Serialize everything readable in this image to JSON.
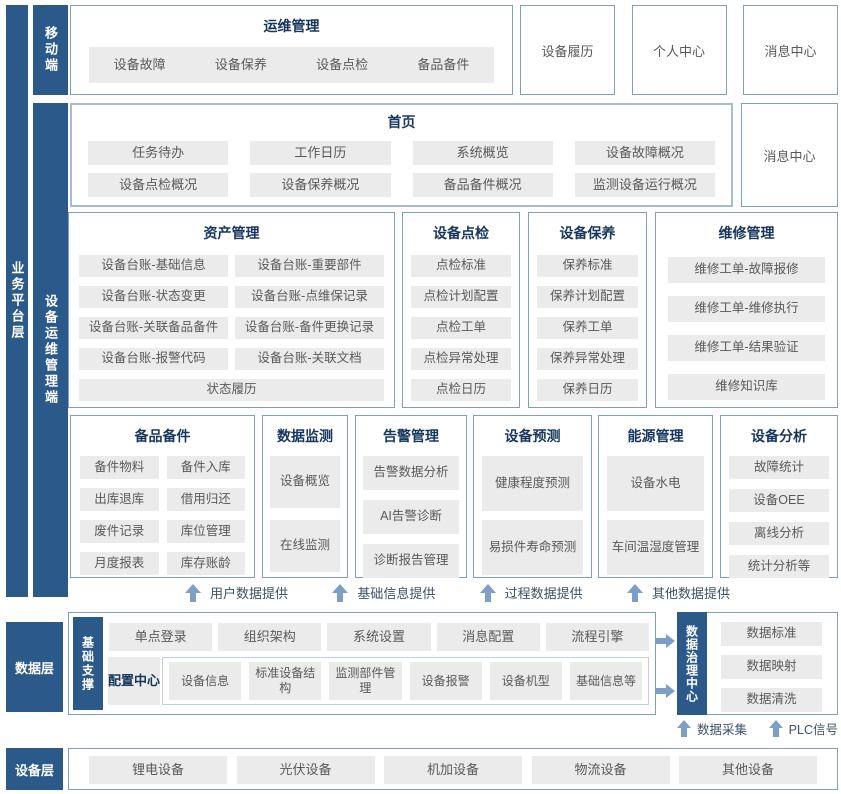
{
  "colors": {
    "rail_bg": "#2b5a8a",
    "box_border": "#7f9fbf",
    "home_box_border": "#a6bcd2",
    "button_bg": "#ebebeb",
    "button_text": "#595959",
    "title_text": "#17365d",
    "arrow": "#7d9ec7"
  },
  "rails": {
    "business_platform": "业务平台层",
    "mobile": "移动端",
    "device_ops": "设备运维管理端"
  },
  "mobile_band": {
    "title": "运维管理",
    "items": [
      "设备故障",
      "设备保养",
      "设备点检",
      "备品备件"
    ],
    "side_boxes": [
      "设备履历",
      "个人中心",
      "消息中心"
    ]
  },
  "home_band": {
    "title": "首页",
    "items": [
      "任务待办",
      "工作日历",
      "系统概览",
      "设备故障概况",
      "设备点检概况",
      "设备保养概况",
      "备品备件概况",
      "监测设备运行概况"
    ],
    "side_box": "消息中心"
  },
  "asset_band": {
    "asset": {
      "title": "资产管理",
      "items": [
        "设备台账-基础信息",
        "设备台账-重要部件",
        "设备台账-状态变更",
        "设备台账-点维保记录",
        "设备台账-关联备品备件",
        "设备台账-备件更换记录",
        "设备台账-报警代码",
        "设备台账-关联文档",
        "状态履历"
      ]
    },
    "inspection": {
      "title": "设备点检",
      "items": [
        "点检标准",
        "点检计划配置",
        "点检工单",
        "点检异常处理",
        "点检日历"
      ]
    },
    "maintenance": {
      "title": "设备保养",
      "items": [
        "保养标准",
        "保养计划配置",
        "保养工单",
        "保养异常处理",
        "保养日历"
      ]
    },
    "repair": {
      "title": "维修管理",
      "items": [
        "维修工单-故障报修",
        "维修工单-维修执行",
        "维修工单-结果验证",
        "维修知识库"
      ]
    }
  },
  "analysis_band": {
    "spares": {
      "title": "备品备件",
      "items": [
        "备件物料",
        "备件入库",
        "出库退库",
        "借用归还",
        "废件记录",
        "库位管理",
        "月度报表",
        "库存账龄"
      ]
    },
    "monitor": {
      "title": "数据监测",
      "items": [
        "设备概览",
        "在线监测"
      ]
    },
    "alarm": {
      "title": "告警管理",
      "items": [
        "告警数据分析",
        "AI告警诊断",
        "诊断报告管理"
      ]
    },
    "predict": {
      "title": "设备预测",
      "items": [
        "健康程度预测",
        "易损件寿命预测"
      ]
    },
    "energy": {
      "title": "能源管理",
      "items": [
        "设备水电",
        "车间温湿度管理"
      ]
    },
    "analysis": {
      "title": "设备分析",
      "items": [
        "故障统计",
        "设备OEE",
        "离线分析",
        "统计分析等"
      ]
    }
  },
  "flow_arrows": [
    "用户数据提供",
    "基础信息提供",
    "过程数据提供",
    "其他数据提供"
  ],
  "data_layer": {
    "label": "数据层",
    "support_label": "基础支撑",
    "base_items": [
      "单点登录",
      "组织架构",
      "系统设置",
      "消息配置",
      "流程引擎"
    ],
    "config_label": "配置中心",
    "config_items": [
      "设备信息",
      "标准设备结构",
      "监测部件管理",
      "设备报警",
      "设备机型",
      "基础信息等"
    ],
    "governance": {
      "label": "数据治理中心",
      "items": [
        "数据标准",
        "数据映射",
        "数据清洗"
      ]
    },
    "bottom_arrows": [
      "数据采集",
      "PLC信号"
    ]
  },
  "device_layer": {
    "label": "设备层",
    "items": [
      "锂电设备",
      "光伏设备",
      "机加设备",
      "物流设备",
      "其他设备"
    ]
  }
}
